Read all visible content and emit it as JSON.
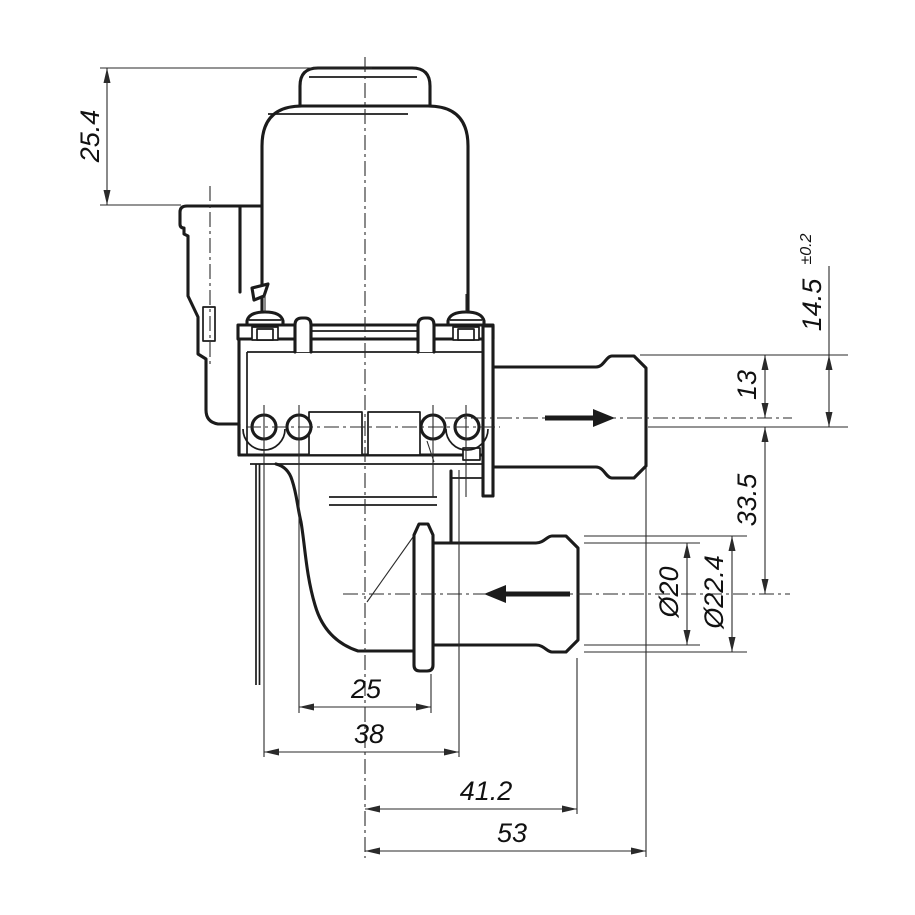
{
  "drawing": {
    "background": "#ffffff",
    "line_color": "#1b1b1b",
    "dim_line_color": "#2a2a2a",
    "labels": {
      "cap_height": "25.4",
      "barb_to_hole_axis_value": "14.5",
      "barb_to_hole_axis_tolerance": "±0.2",
      "barb_to_port_axis": "13",
      "hole_axis_to_lower_port_axis": "33.5",
      "lower_port_inner_diameter": "Ø20",
      "lower_port_outer_diameter": "Ø22.4",
      "hole_to_flange_width": "25",
      "flange_span_width": "38",
      "center_to_lower_port_end": "41.2",
      "center_to_upper_port_end": "53"
    }
  }
}
